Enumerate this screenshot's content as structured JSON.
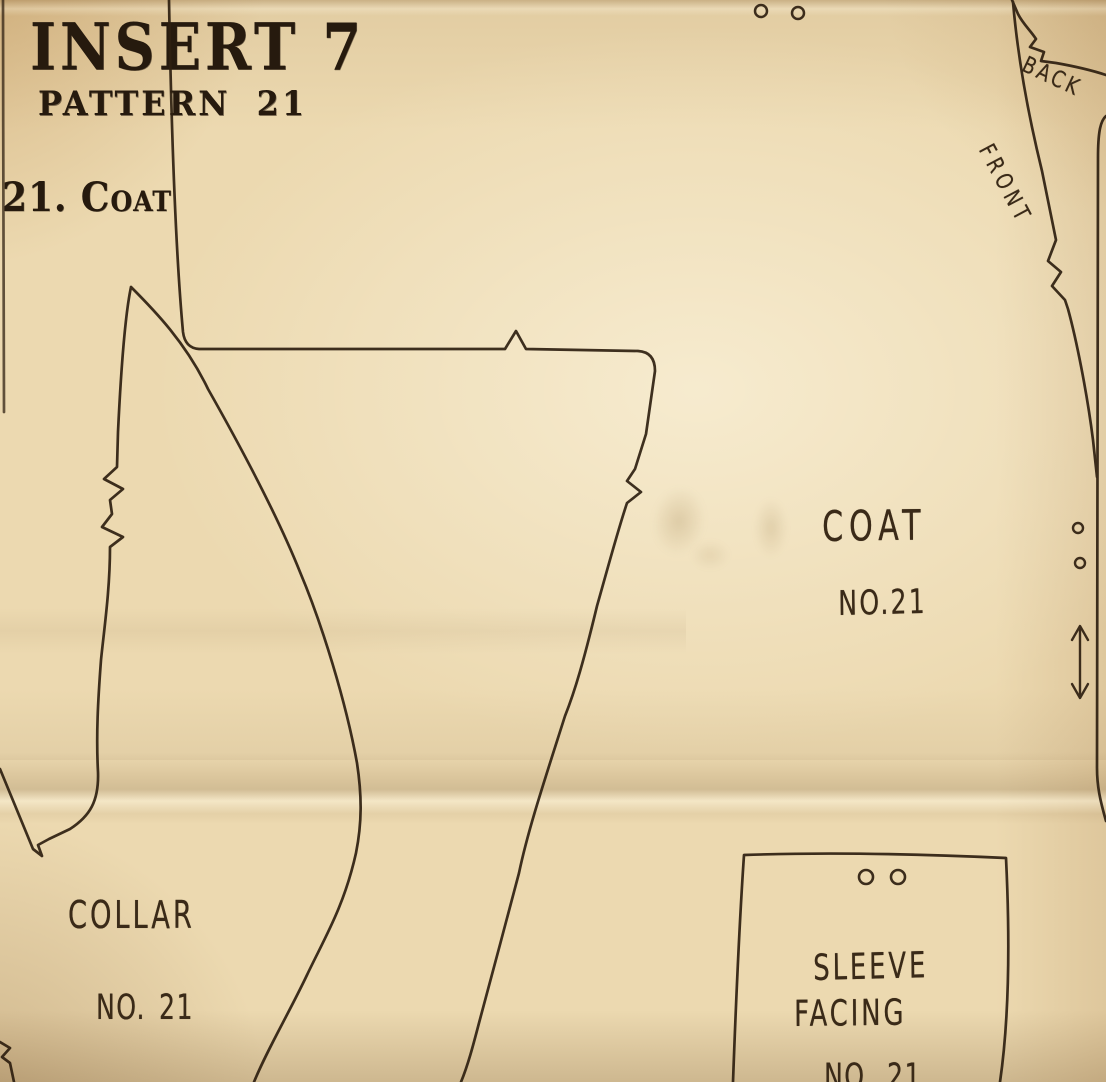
{
  "document": {
    "kind": "vintage sewing pattern insert sheet",
    "header": {
      "title": "INSERT 7",
      "subtitle": "PATTERN 21",
      "index": "21. Coat"
    },
    "labels": {
      "coat": {
        "name": "COAT",
        "number": "NO.21"
      },
      "collar": {
        "name": "COLLAR",
        "number": "NO. 21"
      },
      "sleeve_facing": {
        "line1": "SLEEVE",
        "line2": "FACING",
        "number": "NO. 21"
      },
      "edge_front": "FRONT",
      "edge_back": "BACK"
    },
    "marks": {
      "punch_hole_pairs": 3,
      "grainline_arrow": "double-ended vertical arrow",
      "notches": "zigzag cut notches on piece edges"
    },
    "colors": {
      "paper": "#ecd9b0",
      "ink": "#2e1f10",
      "stamp_ink": "#261a0e"
    }
  }
}
